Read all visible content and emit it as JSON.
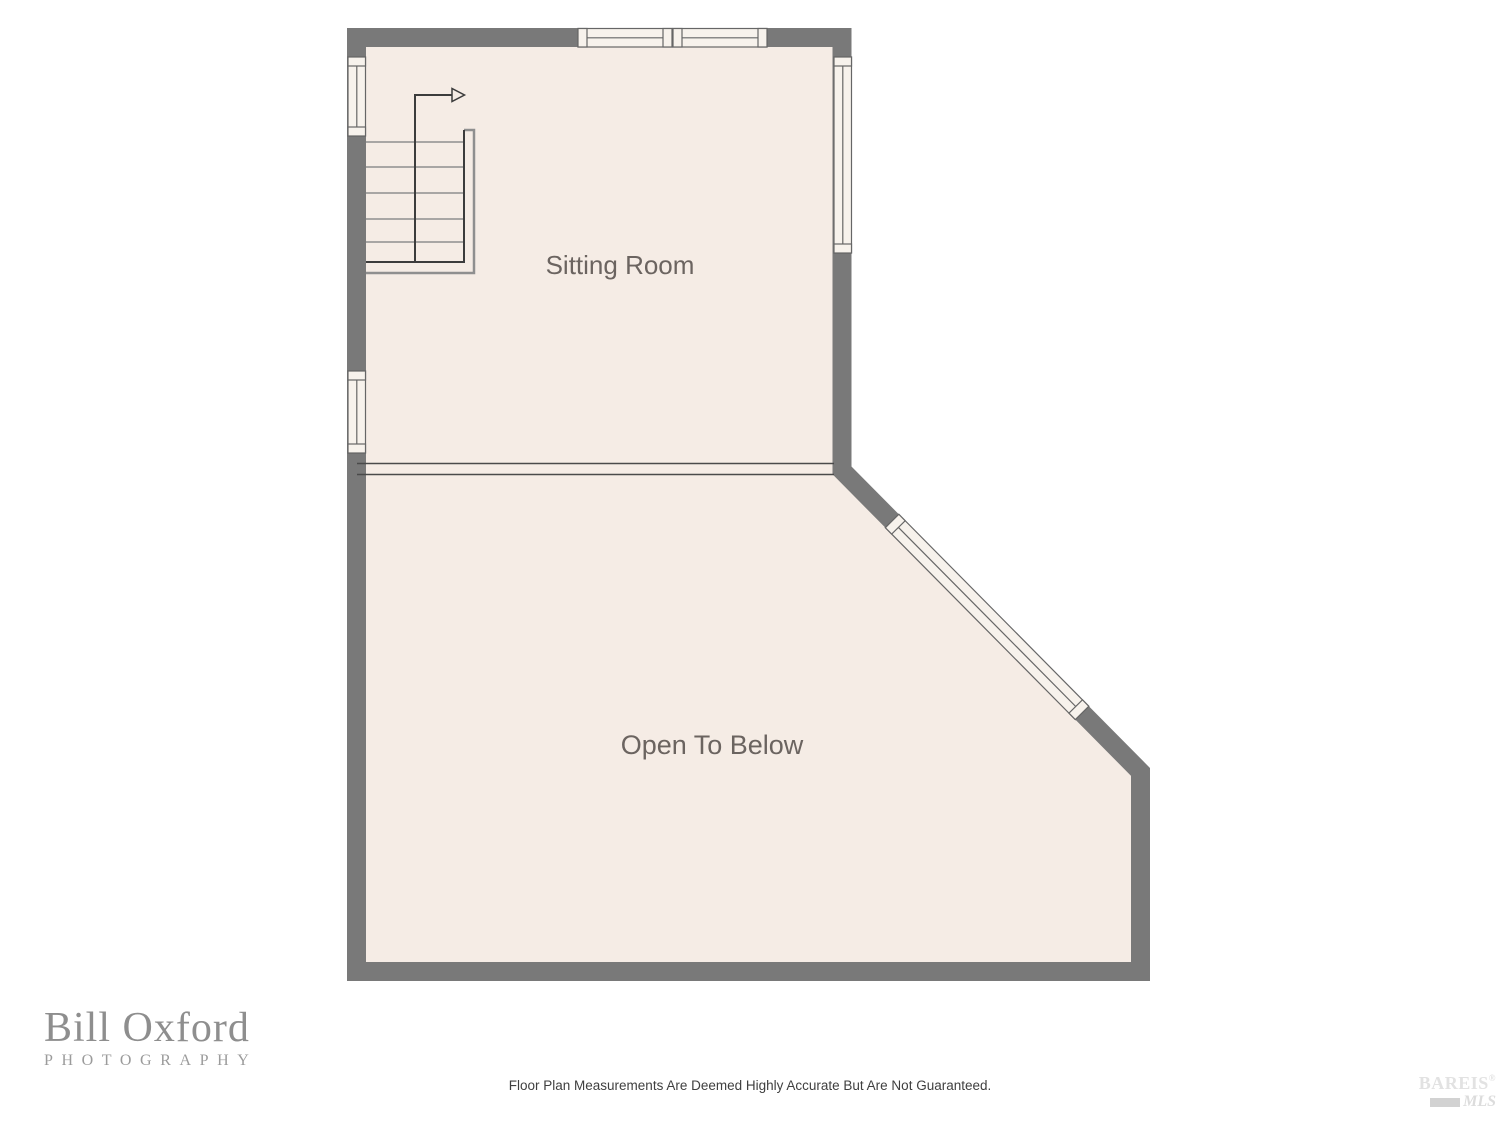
{
  "plan": {
    "rooms": {
      "sitting": {
        "label": "Sitting Room"
      },
      "open_below": {
        "label": "Open To Below"
      }
    },
    "features": {
      "staircase": "u-shaped-staircase-with-up-arrow",
      "windows": [
        "left-wall-upper",
        "left-wall-lower",
        "top-wall-left",
        "top-wall-right",
        "right-wall",
        "diagonal-wall"
      ]
    },
    "colors": {
      "wall": "#797979",
      "floor": "#f5ece5",
      "window_fill": "#f7f2ec",
      "window_border": "#666666",
      "stair_dark": "#3c3c3c",
      "stair_gray": "#8f8f8f",
      "room_label": "#6b6460"
    }
  },
  "footer": {
    "disclaimer": "Floor Plan Measurements Are Deemed Highly Accurate But Are Not Guaranteed."
  },
  "branding": {
    "photographer": {
      "name": "Bill Oxford",
      "subtitle": "PHOTOGRAPHY"
    },
    "mls": {
      "name": "BAREIS",
      "registered": "®",
      "sub": "MLS"
    }
  }
}
